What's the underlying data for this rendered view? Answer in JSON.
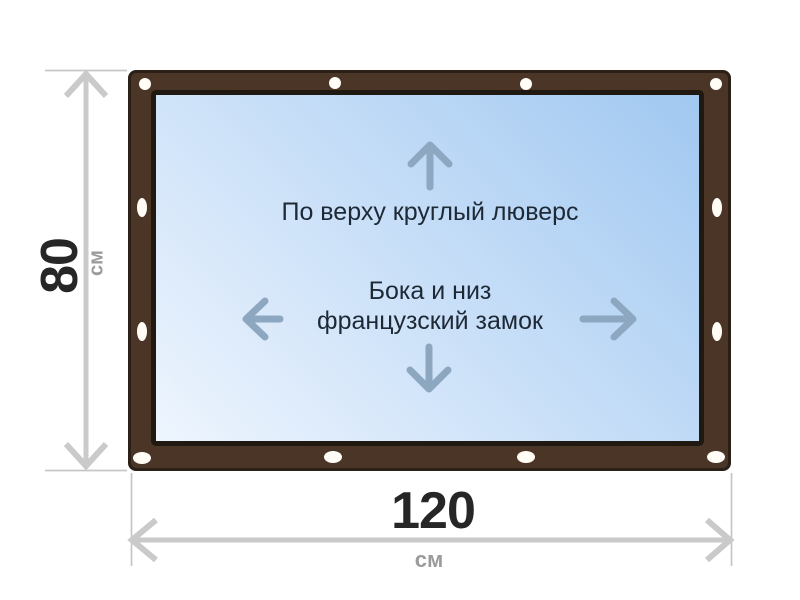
{
  "figure": {
    "type": "tarpaulin-dimension-diagram",
    "panel": {
      "top_note": "По верху круглый люверс",
      "middle_note_line1": "Бока и низ",
      "middle_note_line2": "французский замок"
    },
    "dimensions": {
      "height": {
        "value": "80",
        "unit": "см"
      },
      "width": {
        "value": "120",
        "unit": "см"
      }
    },
    "icons": {
      "up_arrow": "↑",
      "down_arrow": "↓",
      "left_arrow": "←",
      "right_arrow": "→"
    }
  },
  "colors": {
    "background": "#ffffff",
    "frame_brown": "#4a3527",
    "frame_outline": "#2a2018",
    "panel_border": "#1f1911",
    "panel_gradient_light": "#eef5fe",
    "panel_gradient_dark": "#a1c8f1",
    "grommet": "#fffdf6",
    "dimension_line": "#cacaca",
    "extension_line": "#c6c6c6",
    "dimension_value": "#262626",
    "dimension_unit": "#9b9b9b",
    "panel_text": "#1e2936",
    "panel_arrow": "#8ca7bf"
  }
}
